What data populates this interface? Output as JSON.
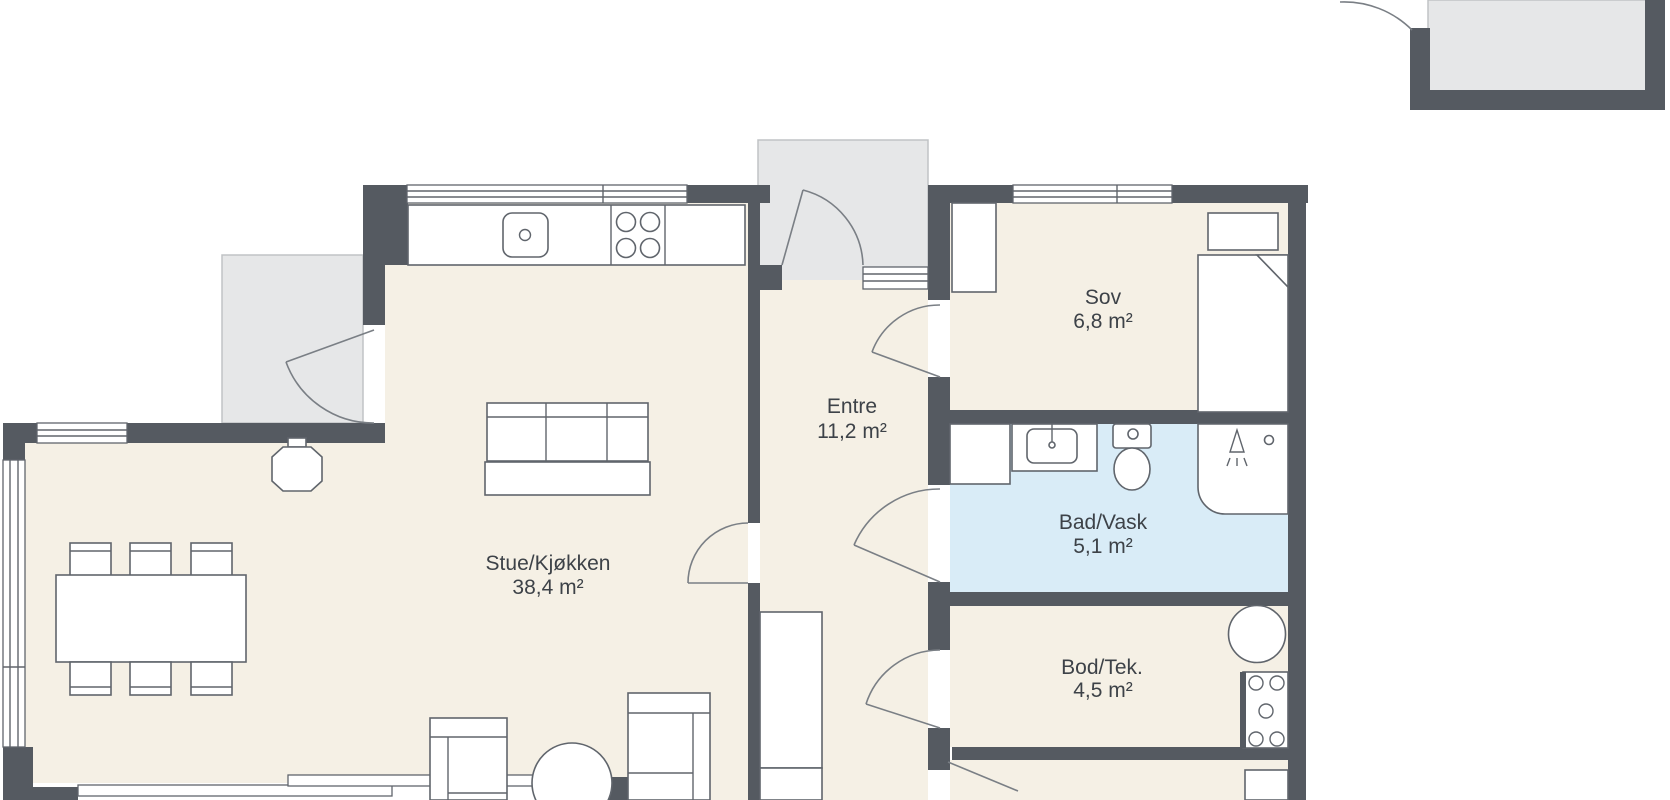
{
  "plan": {
    "type": "floorplan",
    "rooms": [
      {
        "id": "stue",
        "name": "Stue/Kjøkken",
        "area": "38,4 m²"
      },
      {
        "id": "entre",
        "name": "Entre",
        "area": "11,2 m²"
      },
      {
        "id": "sov",
        "name": "Sov",
        "area": "6,8 m²"
      },
      {
        "id": "bad",
        "name": "Bad/Vask",
        "area": "5,1 m²"
      },
      {
        "id": "bod",
        "name": "Bod/Tek.",
        "area": "4,5 m²"
      }
    ],
    "colors": {
      "wall": "#555a61",
      "floor": "#f5f0e5",
      "wet_floor": "#d9ecf7",
      "outdoor": "#e6e7e8",
      "furniture_line": "#60656c",
      "label_text": "#3d4248",
      "background": "#ffffff"
    },
    "icons": [
      "kitchen-counter-icon",
      "kitchen-sink-icon",
      "cooktop-icon",
      "dining-table-icon",
      "chair-icon",
      "pendant-lamp-icon",
      "sofa-icon",
      "armchair-icon",
      "coffee-table-icon",
      "wardrobe-icon",
      "cabinet-icon",
      "bed-icon",
      "washing-machine-icon",
      "sink-vanity-icon",
      "toilet-icon",
      "shower-icon",
      "water-heater-icon",
      "electrical-panel-icon",
      "door-swing-icon",
      "window-icon",
      "sliding-door-icon"
    ]
  }
}
